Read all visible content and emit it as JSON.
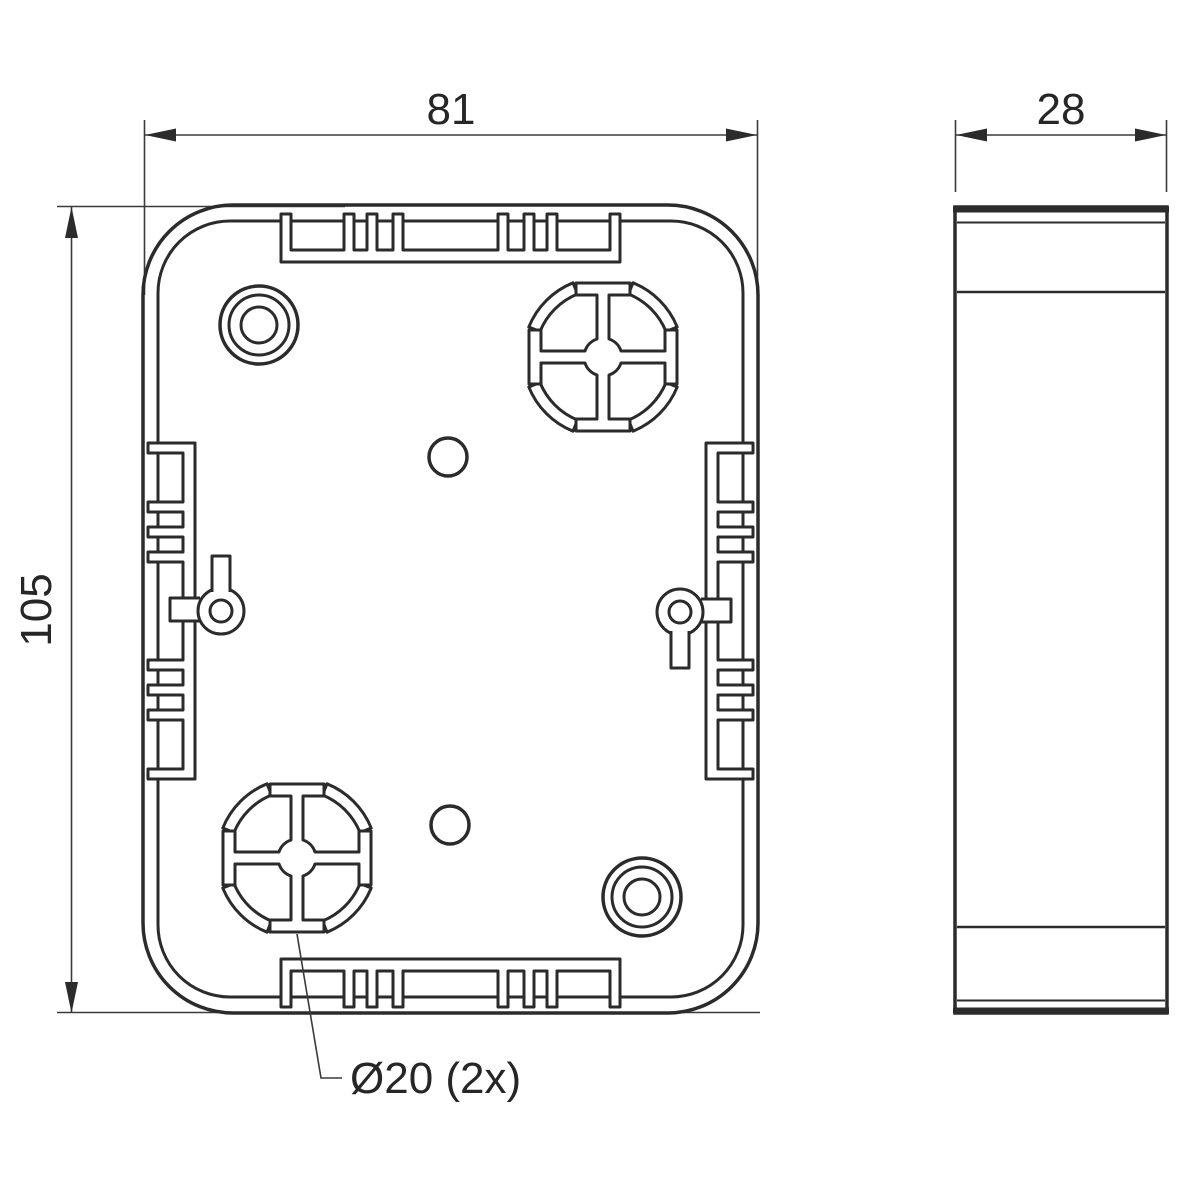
{
  "dims": {
    "width": "81",
    "height": "105",
    "depth": "28",
    "knockout": "Ø20 (2x)"
  },
  "colors": {
    "object_line": "#2b2b2b",
    "dimension_line": "#3a3a3a",
    "text": "#262626",
    "background": "#ffffff"
  }
}
